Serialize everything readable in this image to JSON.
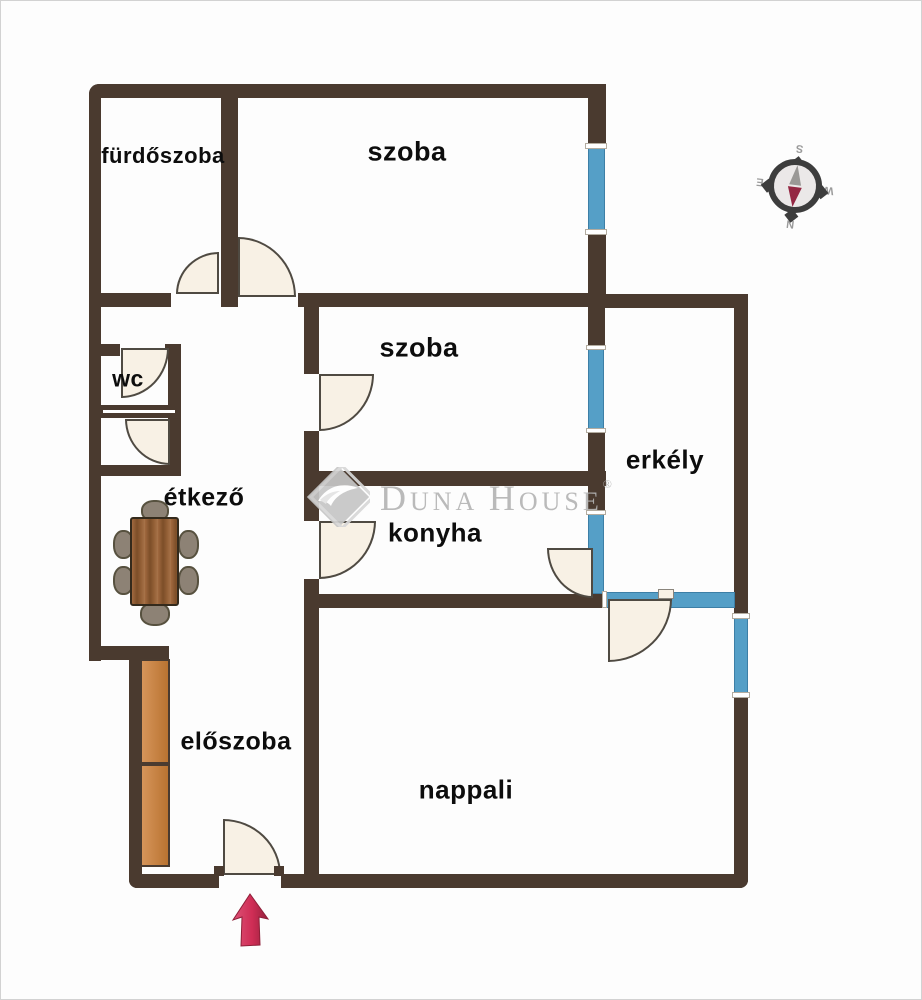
{
  "floorplan": {
    "rooms": [
      {
        "id": "furdoszoba",
        "label": "fürdőszoba"
      },
      {
        "id": "szoba-felso",
        "label": "szoba"
      },
      {
        "id": "wc",
        "label": "wc"
      },
      {
        "id": "szoba-kozepso",
        "label": "szoba"
      },
      {
        "id": "etkezo",
        "label": "étkező"
      },
      {
        "id": "konyha",
        "label": "konyha"
      },
      {
        "id": "erkely",
        "label": "erkély"
      },
      {
        "id": "eloszoba",
        "label": "előszoba"
      },
      {
        "id": "nappali",
        "label": "nappali"
      }
    ],
    "watermark": {
      "brand_initial_1": "D",
      "brand_rest_1": "UNA",
      "brand_initial_2": "H",
      "brand_rest_2": "OUSE",
      "registered_mark": "®"
    },
    "compass": {
      "north": "N",
      "east": "E",
      "south": "S",
      "west": "W"
    },
    "colors": {
      "wall": "#4a3a2f",
      "window_glass": "#559fc7",
      "door_leaf": "#f8f1e5",
      "wardrobe": "#c98440",
      "entrance_arrow": "#cf2d55",
      "watermark_gray": "#b5b5b5"
    }
  }
}
